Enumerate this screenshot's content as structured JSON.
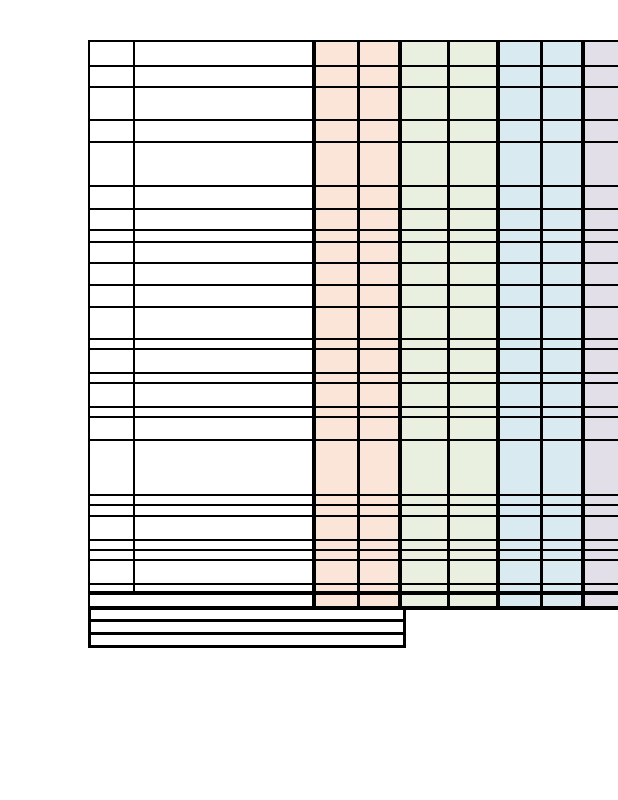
{
  "colors": {
    "page_background": "#FFFFFF",
    "cell_white": "#FFFFFF",
    "peach": "#FBE5D8",
    "green": "#EAF0E0",
    "blue": "#DAEAF1",
    "lavender": "#E2DFE8",
    "border": "#000000"
  },
  "table": {
    "cells_empty": true,
    "columns": [
      {
        "id": "col-1",
        "fill": "white",
        "width": 45,
        "sep": "hair"
      },
      {
        "id": "col-2",
        "fill": "white",
        "width": 181,
        "sep": "thick"
      },
      {
        "id": "col-3",
        "fill": "peach",
        "width": 44,
        "sep": "thin"
      },
      {
        "id": "col-4",
        "fill": "peach",
        "width": 42,
        "sep": "thick"
      },
      {
        "id": "col-5",
        "fill": "green",
        "width": 48,
        "sep": "thin"
      },
      {
        "id": "col-6",
        "fill": "green",
        "width": 50,
        "sep": "thick"
      },
      {
        "id": "col-7",
        "fill": "blue",
        "width": 43,
        "sep": "thin"
      },
      {
        "id": "col-8",
        "fill": "blue",
        "width": 42,
        "sep": "thick"
      },
      {
        "id": "col-9",
        "fill": "lavender",
        "width": 33,
        "sep": "none"
      }
    ],
    "row_heights": [
      25,
      21,
      33,
      22,
      44,
      23,
      21,
      12,
      21,
      22,
      22,
      32,
      10,
      24,
      10,
      24,
      10,
      23,
      55,
      10,
      11,
      24,
      10,
      10,
      24,
      10
    ],
    "total_row": {
      "height": 15,
      "merged_first_two": true
    },
    "footer_row_heights": [
      12,
      13,
      13
    ]
  }
}
